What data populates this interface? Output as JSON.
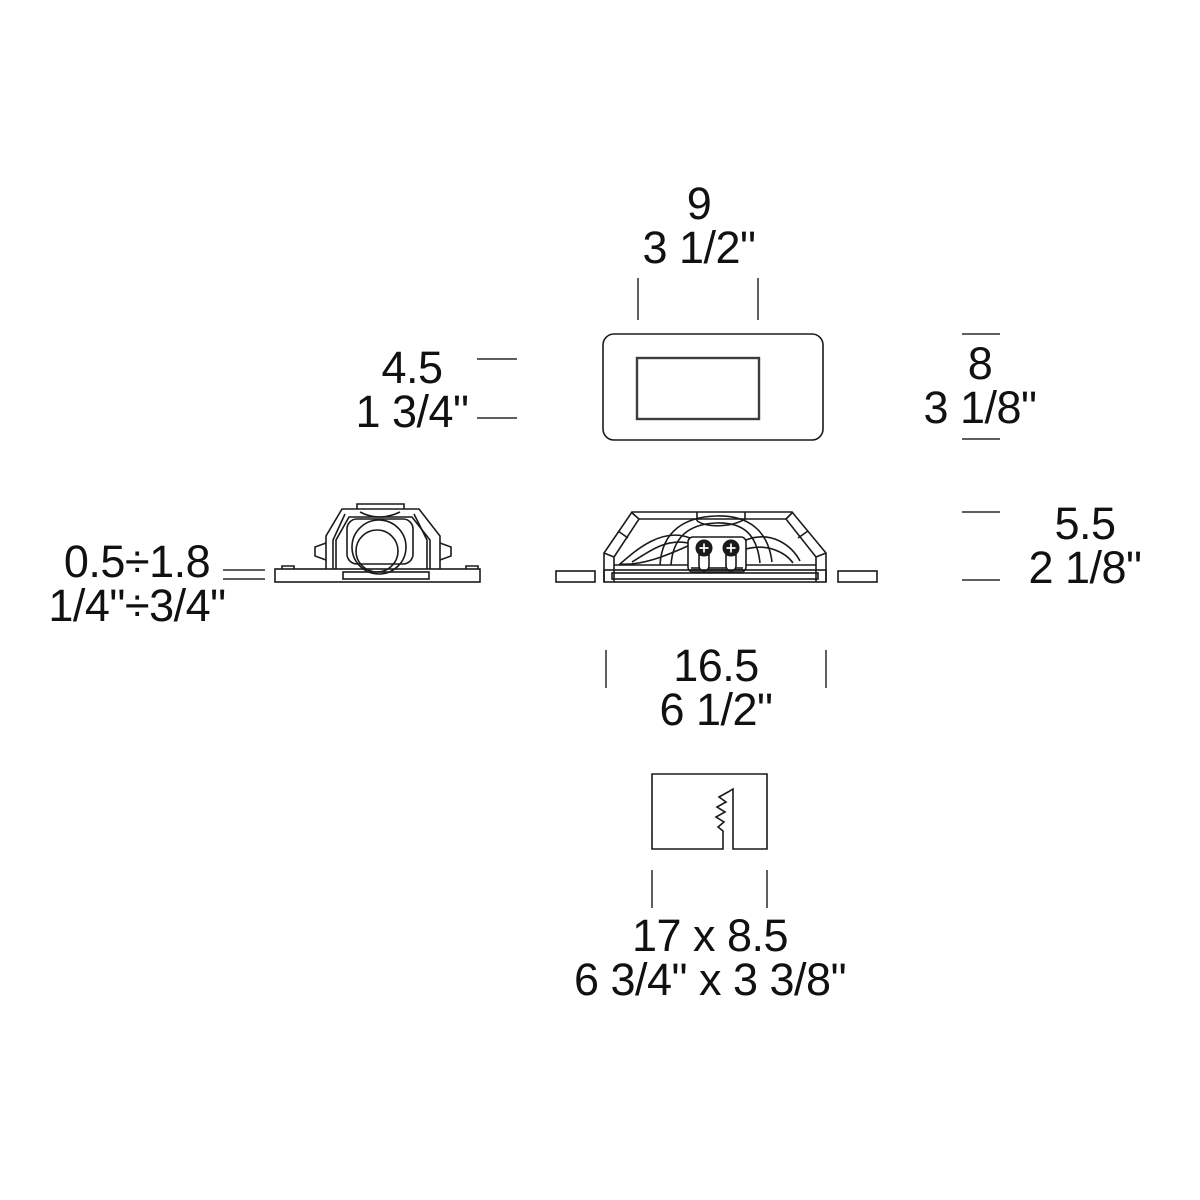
{
  "background": "#ffffff",
  "line_color": "#1a1a1a",
  "text_color": "#111111",
  "dimensions": {
    "window_width": {
      "metric": "9",
      "imperial": "3 1/2\""
    },
    "window_height": {
      "metric": "4.5",
      "imperial": "1 3/4\""
    },
    "plate_height": {
      "metric": "8",
      "imperial": "3 1/8\""
    },
    "recess_depth": {
      "metric": "0.5÷1.8",
      "imperial": "1/4\"÷3/4\""
    },
    "body_height": {
      "metric": "5.5",
      "imperial": "2 1/8\""
    },
    "plate_width": {
      "metric": "16.5",
      "imperial": "6 1/2\""
    },
    "cutout_size": {
      "metric": "17 x 8.5",
      "imperial": "6 3/4\" x 3 3/8\""
    }
  }
}
